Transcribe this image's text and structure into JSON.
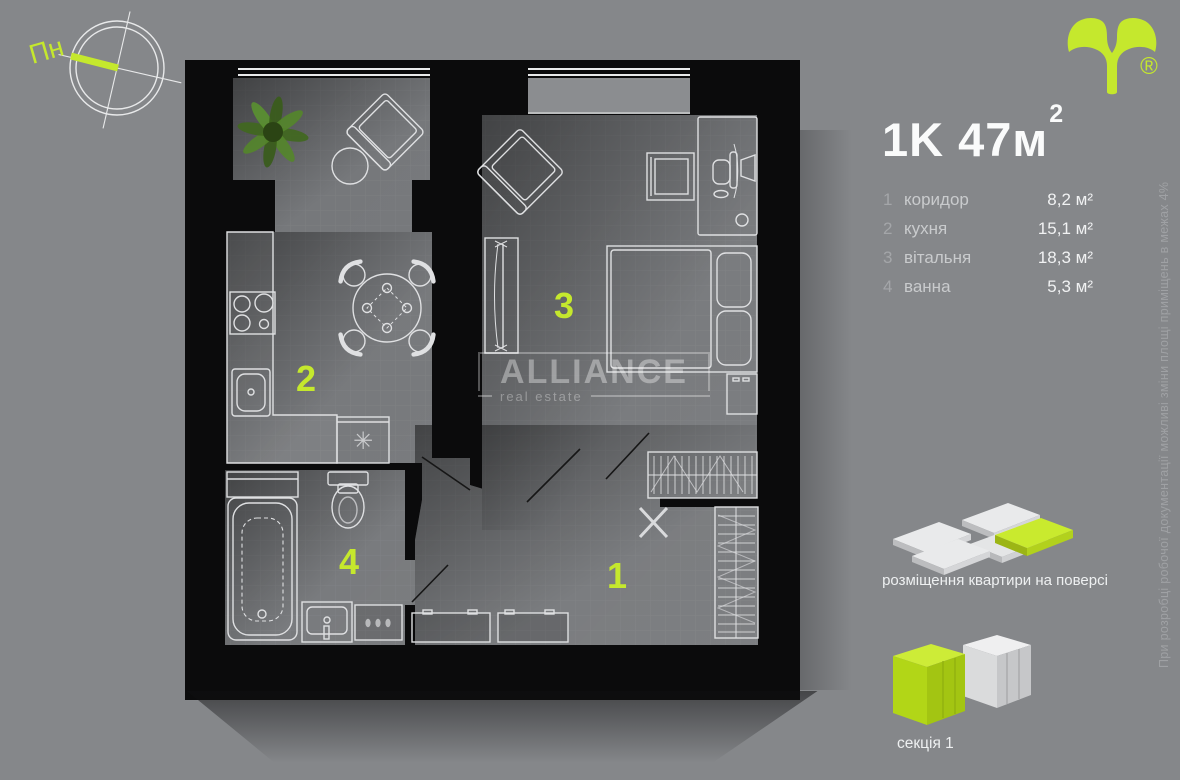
{
  "colors": {
    "background": "#85878a",
    "accent": "#c5e82d",
    "wall": "#0b0b0c",
    "room": "#747679"
  },
  "compass": {
    "label": "Пн"
  },
  "logo": {
    "trademark": "®"
  },
  "plan_title": {
    "main": "1K 47",
    "unit": "м",
    "sup": "2"
  },
  "legend": {
    "rows": [
      {
        "num": "1",
        "name": "коридор",
        "area": "8,2 м²"
      },
      {
        "num": "2",
        "name": "кухня",
        "area": "15,1 м²"
      },
      {
        "num": "3",
        "name": "вітальня",
        "area": "18,3 м²"
      },
      {
        "num": "4",
        "name": "ванна",
        "area": "5,3 м²"
      }
    ]
  },
  "plan": {
    "room_labels": {
      "corridor": "1",
      "kitchen": "2",
      "living": "3",
      "bathroom": "4"
    },
    "washer_symbol": "✳"
  },
  "watermark": {
    "brand": "ALLIANCE",
    "tagline": "real estate"
  },
  "disclaimer": "При розробці робочої документації можливі зміни площі приміщень в межах 4%",
  "placement": {
    "caption": "розміщення квартири на поверсі"
  },
  "section": {
    "caption": "секція 1"
  }
}
